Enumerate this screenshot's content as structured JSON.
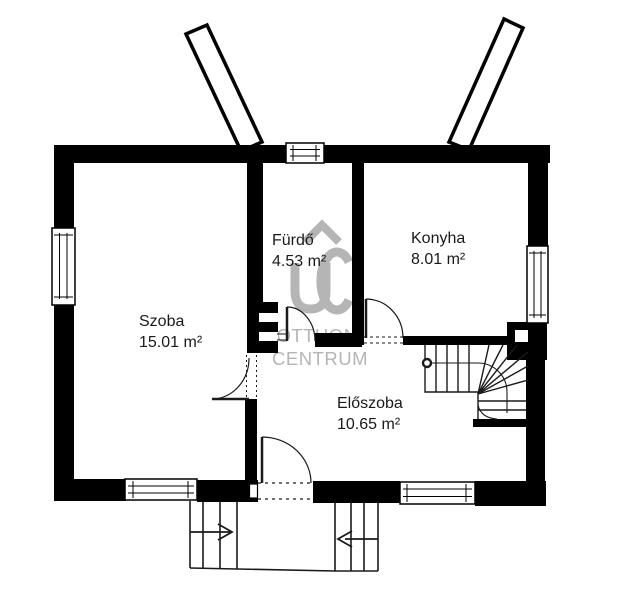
{
  "rooms": [
    {
      "id": "szoba",
      "label": "Szoba",
      "area": "15.01 m²"
    },
    {
      "id": "furdo",
      "label": "Fürdő",
      "area": "4.53 m²"
    },
    {
      "id": "konyha",
      "label": "Konyha",
      "area": "8.01 m²"
    },
    {
      "id": "eloszoba",
      "label": "Előszoba",
      "area": "10.65 m²"
    }
  ],
  "watermark": {
    "line1": "OTTHON",
    "line2": "CENTRUM"
  },
  "colors": {
    "wall": "#000000",
    "line": "#1a1a1a",
    "watermark": "#b5b5b5",
    "background": "#ffffff"
  }
}
